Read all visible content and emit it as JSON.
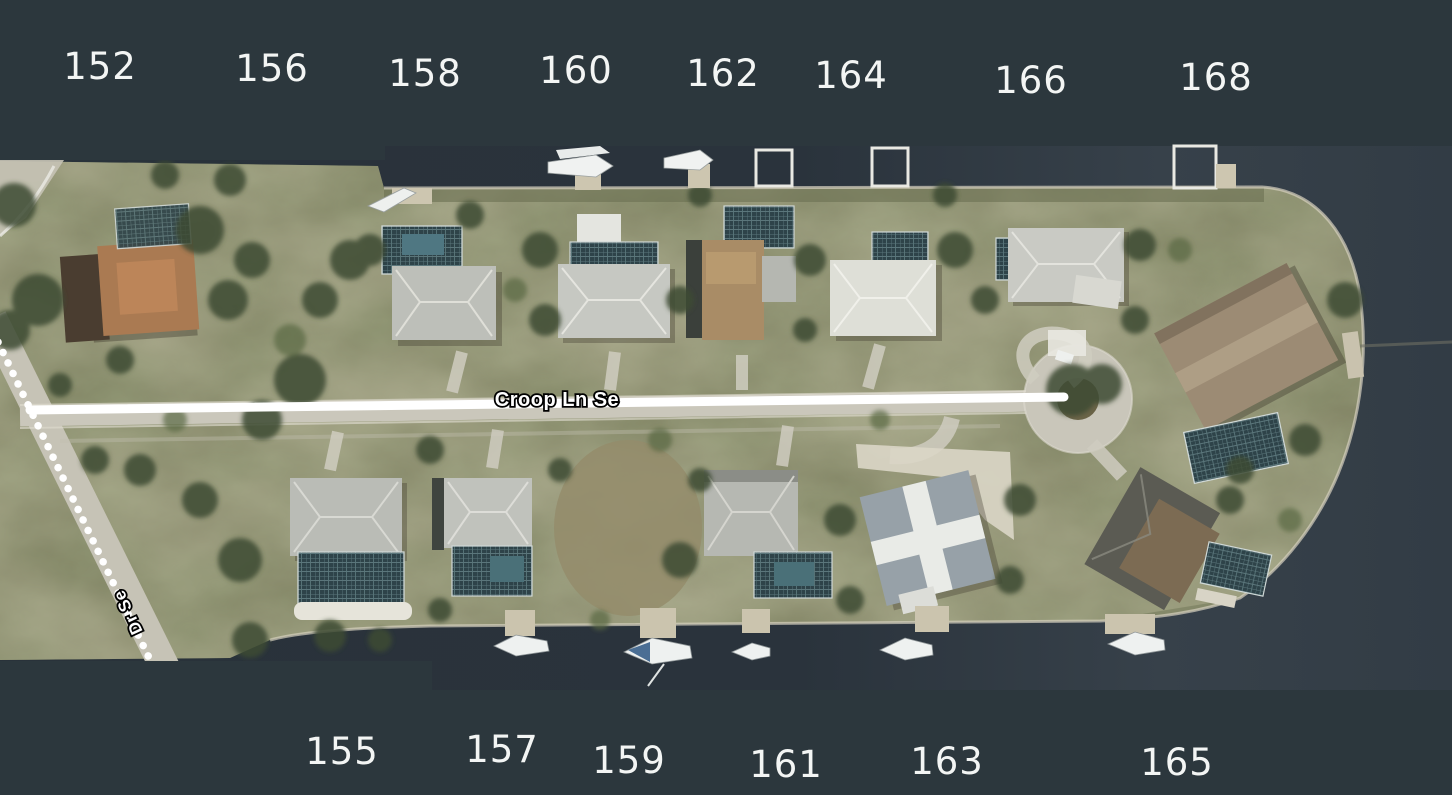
{
  "map": {
    "street_label": "Croop Ln Se",
    "cross_street_label": "Dr Se"
  },
  "addresses": {
    "top": [
      "152",
      "156",
      "158",
      "160",
      "162",
      "164",
      "166",
      "168"
    ],
    "bottom": [
      "155",
      "157",
      "159",
      "161",
      "163",
      "165"
    ]
  },
  "colors": {
    "background": "#2c373d",
    "canal_water": "#2a333c",
    "land": "#767959",
    "road": "#cac7bb",
    "route_highlight": "#ffffff",
    "address_text": "#f3f5f4",
    "street_label_text": "#ffffff",
    "street_label_outline": "#000000"
  }
}
